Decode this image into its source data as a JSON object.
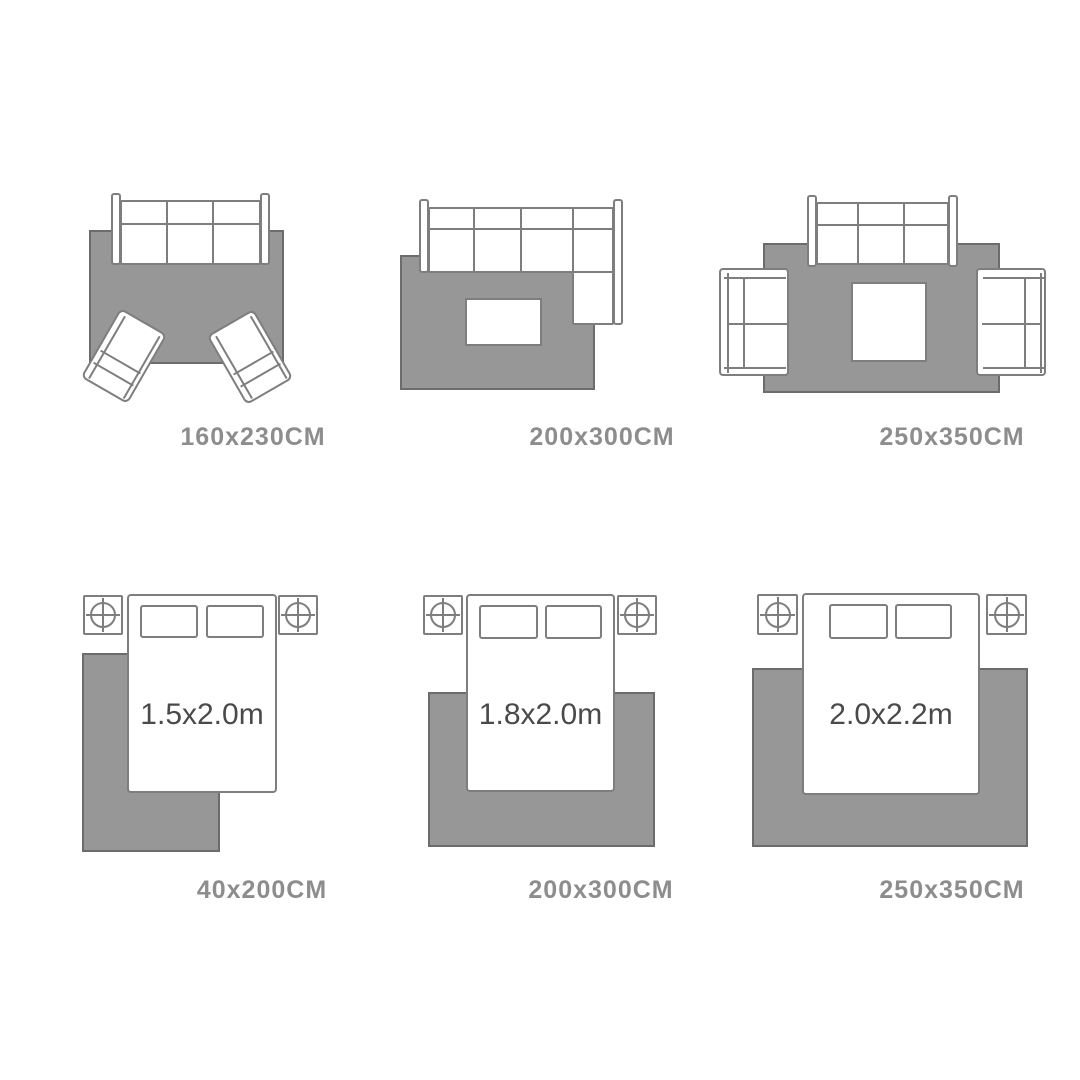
{
  "colors": {
    "rug-fill": "#979797",
    "rug-border": "#6c6c6c",
    "line": "#7e7e7e",
    "label": "#8d8d8d",
    "bedtext": "#4a4a4a"
  },
  "living_room": [
    {
      "id": "sofa-with-two-accent-chairs",
      "rug_size": "160x230CM"
    },
    {
      "id": "sectional-sofa-with-coffee-table",
      "rug_size": "200x300CM"
    },
    {
      "id": "sofa-two-loveseats-coffee-table",
      "rug_size": "250x350CM"
    }
  ],
  "bedroom": [
    {
      "id": "bed-offset-rug",
      "bed_size": "1.5x2.0m",
      "rug_size": "40x200CM"
    },
    {
      "id": "bed-centered-rug",
      "bed_size": "1.8x2.0m",
      "rug_size": "200x300CM"
    },
    {
      "id": "bed-centered-rug-large",
      "bed_size": "2.0x2.2m",
      "rug_size": "250x350CM"
    }
  ]
}
